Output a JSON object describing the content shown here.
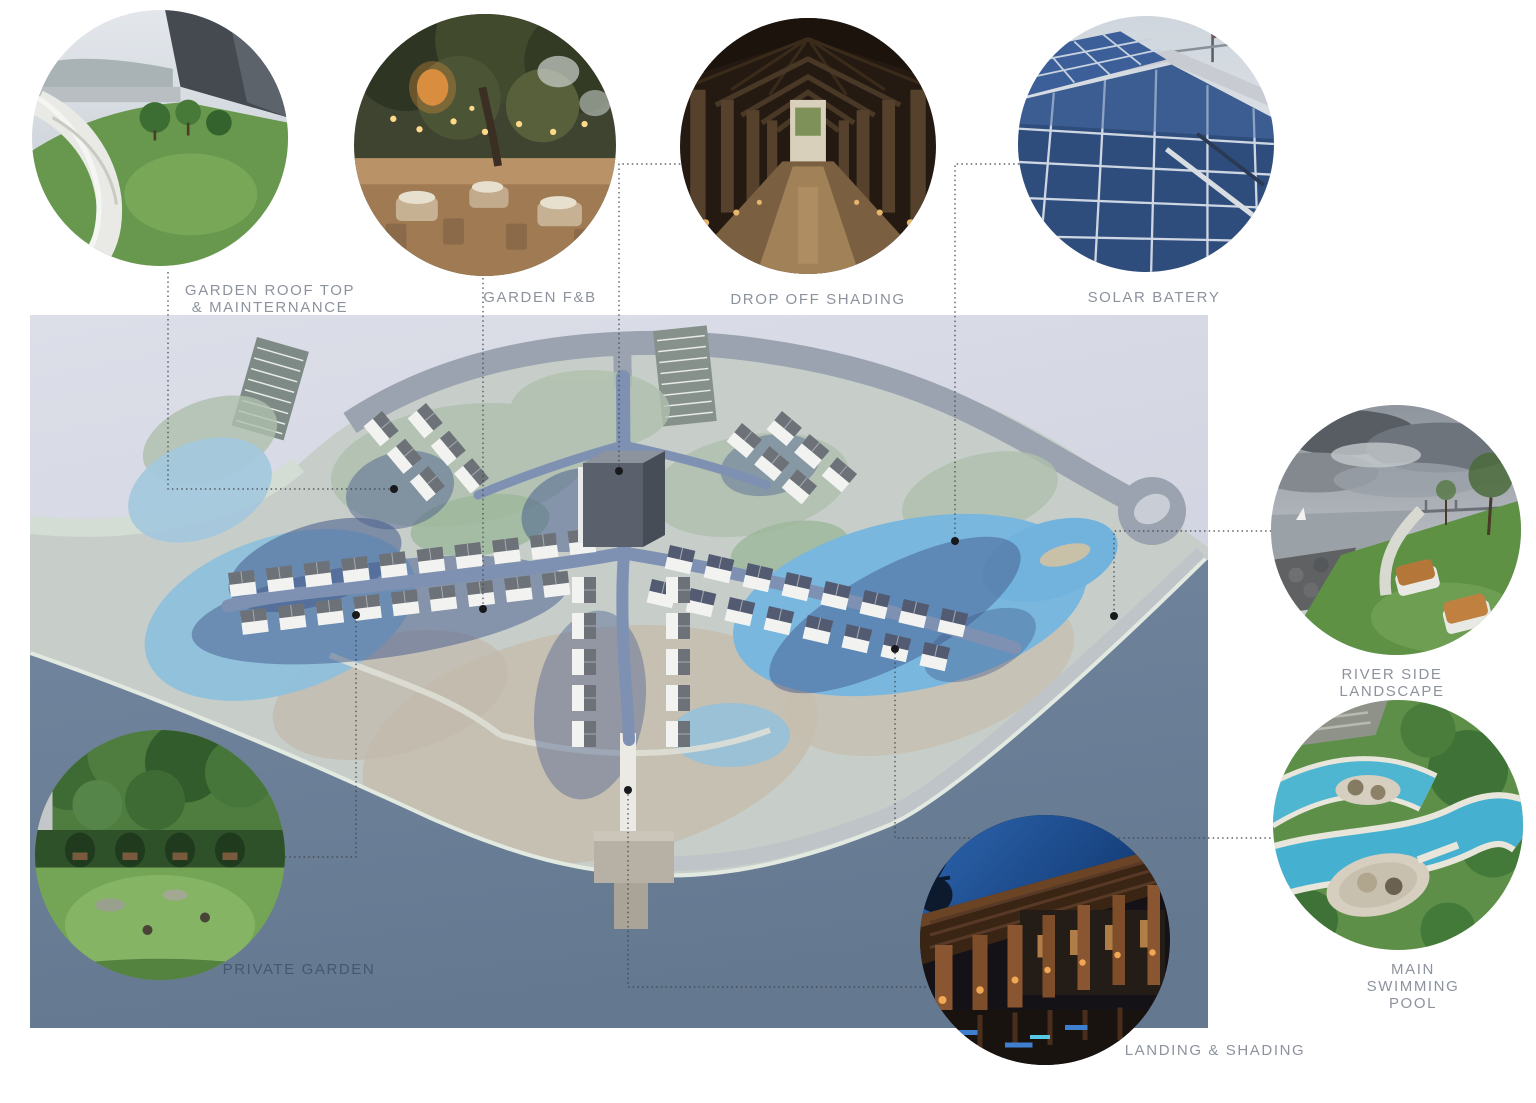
{
  "page": {
    "background": "#ffffff",
    "kind": "architecture masterplan presentation diagram"
  },
  "plan": {
    "name": "aerial resort masterplan rendering"
  },
  "callouts": [
    {
      "id": "garden-roof-top",
      "label": "GARDEN ROOF TOP\n& MAINTERNANCE",
      "photo": "green roof lawn with curved white walkway and city view"
    },
    {
      "id": "garden-fb",
      "label": "GARDEN F&B",
      "photo": "outdoor garden restaurant under trees with string lights"
    },
    {
      "id": "drop-off-shading",
      "label": "DROP OFF SHADING",
      "photo": "timber colonnade drop-off corridor"
    },
    {
      "id": "solar-batery",
      "label": "SOLAR BATERY",
      "photo": "rooftop solar photovoltaic panel array"
    },
    {
      "id": "river-side-landscape",
      "label": "RIVER SIDE LANDSCAPE",
      "photo": "riverside lawn with wooden lounge benches under cloudy sky"
    },
    {
      "id": "main-swimming-pool",
      "label": "MAIN SWIMMING POOL",
      "photo": "aerial lagoon swimming pool with oval island deck"
    },
    {
      "id": "private-garden",
      "label": "PRIVATE GARDEN",
      "photo": "secluded hedge garden with round lawns and benches"
    },
    {
      "id": "landing-shading",
      "label": "LANDING & SHADING",
      "photo": "night-lit timber pergola landing walkway"
    }
  ],
  "colors": {
    "label_text": "#8d939d",
    "label_text_on_water": "#44586f",
    "leader_line": "#3f444c",
    "leader_dot": "#17191d",
    "plan_land": "#c7cec9",
    "plan_outside": "#d6d9e3",
    "plan_road_gray": "#9aa3af",
    "plan_road_blue": "#7e91b3",
    "plan_lagoon": "#79b7de",
    "plan_water_dark": "#6d8099",
    "building_roof": "#6d7279",
    "building_wall": "#f2f3f1"
  }
}
